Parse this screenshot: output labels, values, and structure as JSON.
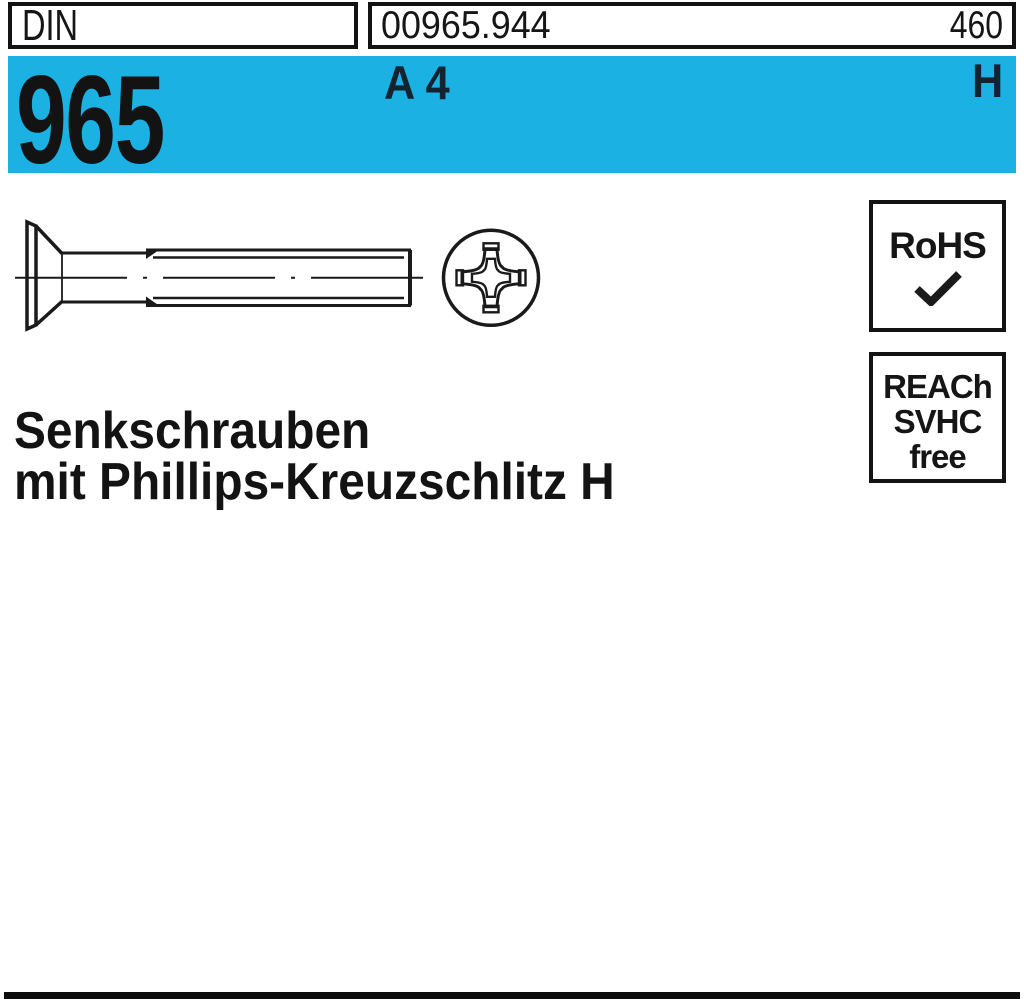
{
  "colors": {
    "banner_cyan": "#1bb1e2",
    "line_black": "#131313",
    "background": "#ffffff"
  },
  "header": {
    "din_label": "DIN",
    "article_number": "00965.944",
    "catalog_page": "460"
  },
  "banner": {
    "standard_number": "965",
    "material_grade": "A 4",
    "drive_symbol": "H"
  },
  "drawing": {
    "description": "countersunk screw side view with thread and phillips head front view"
  },
  "badges": {
    "rohs": {
      "label": "RoHS"
    },
    "reach": {
      "line1": "REACh",
      "line2": "SVHC",
      "line3": "free"
    }
  },
  "title": {
    "line1": "Senkschrauben",
    "line2": "mit Phillips-Kreuzschlitz H"
  }
}
